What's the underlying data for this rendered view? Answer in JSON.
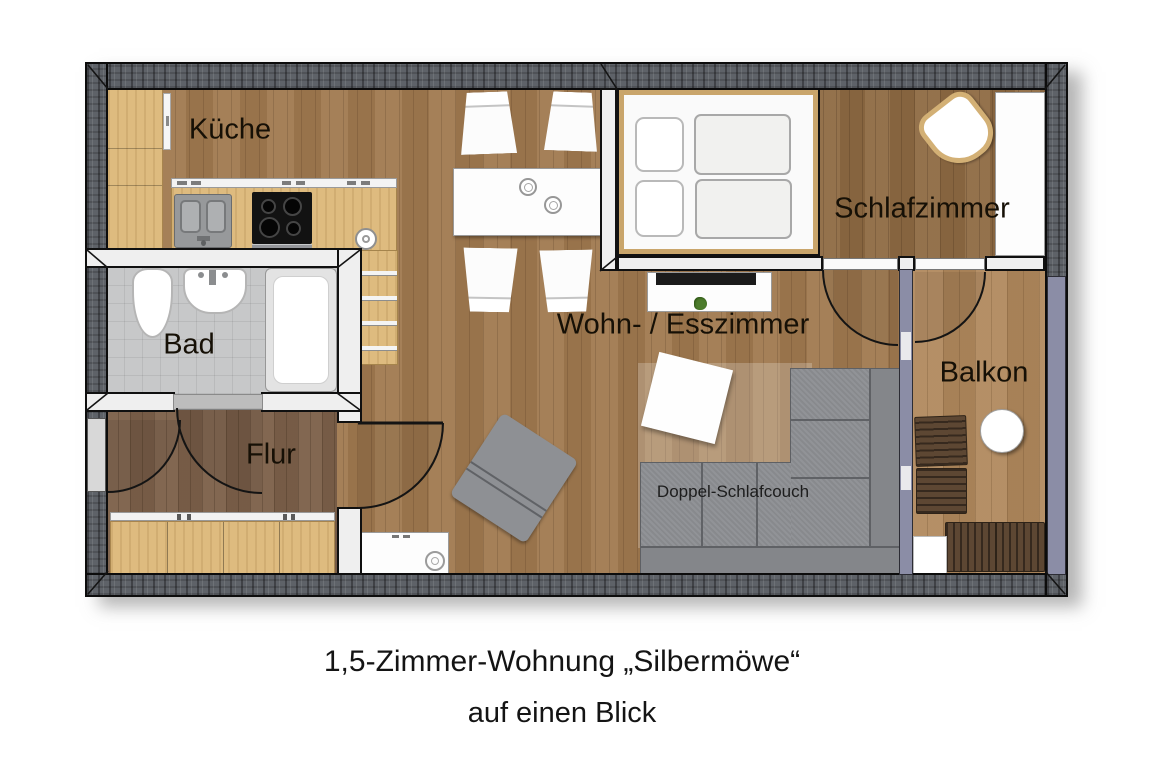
{
  "rooms": {
    "kitchen": {
      "label": "Küche"
    },
    "bathroom": {
      "label": "Bad"
    },
    "hallway": {
      "label": "Flur"
    },
    "living_dining": {
      "label": "Wohn- / Esszimmer"
    },
    "bedroom": {
      "label": "Schlafzimmer"
    },
    "balcony": {
      "label": "Balkon"
    }
  },
  "furniture": {
    "sleeper_sofa_label": "Doppel-Schlafcouch",
    "items": [
      "kitchen-cabinets",
      "sink",
      "stove",
      "shelf-unit",
      "dining-table",
      "chairs",
      "double-bed",
      "wardrobe",
      "armchair",
      "tv-sideboard",
      "plant",
      "side-table",
      "lounge-chair",
      "corner-sofa",
      "rug",
      "dresser",
      "hall-sideboard",
      "toilet",
      "washbasin",
      "shower",
      "balcony-chairs",
      "balcony-round-table",
      "balcony-bench"
    ]
  },
  "caption": {
    "line1": "1,5-Zimmer-Wohnung „Silbermöwe“",
    "line2": "auf einen Blick"
  },
  "colors": {
    "outer_wall": "#5e6268",
    "floor_wood": "#a0794f",
    "floor_balcony": "#b0885c",
    "cabinet_wood": "#debb7f",
    "bath_tile": "#c7c8c9",
    "sofa_gray": "#8d8f93",
    "railing_slate": "#8b8da6"
  }
}
